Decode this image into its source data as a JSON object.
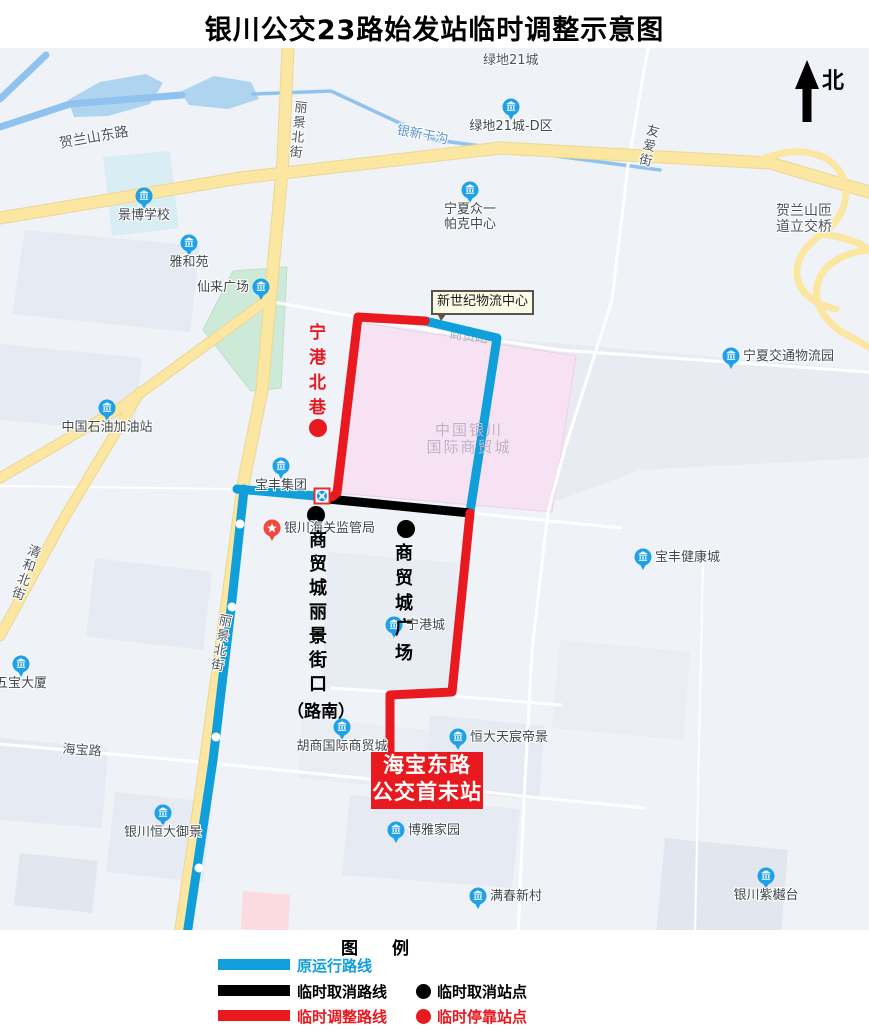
{
  "title": "银川公交23路始发站临时调整示意图",
  "north": {
    "label": "北"
  },
  "callout": {
    "text": "新世纪物流中心"
  },
  "terminus": {
    "line1": "海宝东路",
    "line2": "公交首末站"
  },
  "legend": {
    "title": "图　　例",
    "rows": [
      {
        "color": "#119fdc",
        "label": "原运行路线"
      },
      {
        "color": "#000000",
        "label": "临时取消路线",
        "dot_color": "#000000",
        "dot_label": "临时取消站点"
      },
      {
        "color": "#e8191f",
        "label": "临时调整路线",
        "dot_color": "#e8191f",
        "dot_label": "临时停靠站点"
      }
    ]
  },
  "colors": {
    "route_original": "#119fdc",
    "route_cancelled": "#000000",
    "route_adjusted": "#e8191f",
    "map_bg": "#eff2f7",
    "parcel": "#e6eaf2",
    "water": "#aed4f0",
    "water_line": "#8fc3ee",
    "road_yellow": "#fbe7a1",
    "road_yellow_edge": "#ecd793",
    "road_white": "#ffffff",
    "poi_blue": "#1ea1e6",
    "poi_red": "#f0483f",
    "area_label": "#c2b2c8"
  },
  "map": {
    "parcels": [
      {
        "p": [
          [
            25,
            230
          ],
          [
            200,
            246
          ],
          [
            190,
            332
          ],
          [
            12,
            314
          ]
        ]
      },
      {
        "p": [
          [
            0,
            344
          ],
          [
            142,
            358
          ],
          [
            134,
            432
          ],
          [
            0,
            420
          ]
        ]
      },
      {
        "p": [
          [
            95,
            558
          ],
          [
            212,
            572
          ],
          [
            203,
            650
          ],
          [
            86,
            637
          ]
        ]
      },
      {
        "p": [
          [
            0,
            738
          ],
          [
            108,
            748
          ],
          [
            102,
            828
          ],
          [
            0,
            820
          ]
        ]
      },
      {
        "p": [
          [
            328,
            552
          ],
          [
            458,
            563
          ],
          [
            450,
            700
          ],
          [
            322,
            688
          ]
        ],
        "f": "#e8ecf3"
      },
      {
        "p": [
          [
            438,
            333
          ],
          [
            869,
            370
          ],
          [
            869,
            458
          ],
          [
            640,
            470
          ],
          [
            560,
            500
          ],
          [
            445,
            505
          ]
        ],
        "f": "#e8ecf2"
      },
      {
        "p": [
          [
            560,
            640
          ],
          [
            690,
            652
          ],
          [
            683,
            740
          ],
          [
            552,
            728
          ]
        ],
        "f": "#eaeef4"
      },
      {
        "p": [
          [
            302,
            718
          ],
          [
            430,
            730
          ],
          [
            426,
            790
          ],
          [
            298,
            778
          ]
        ],
        "f": "#eaeef4"
      },
      {
        "p": [
          [
            430,
            715
          ],
          [
            545,
            726
          ],
          [
            539,
            800
          ],
          [
            424,
            789
          ]
        ]
      },
      {
        "p": [
          [
            350,
            795
          ],
          [
            520,
            809
          ],
          [
            512,
            888
          ],
          [
            342,
            875
          ]
        ]
      },
      {
        "p": [
          [
            665,
            838
          ],
          [
            788,
            850
          ],
          [
            781,
            935
          ],
          [
            656,
            935
          ]
        ],
        "f": "#e2e7ef"
      },
      {
        "p": [
          [
            115,
            792
          ],
          [
            212,
            802
          ],
          [
            203,
            882
          ],
          [
            106,
            872
          ]
        ]
      },
      {
        "p": [
          [
            20,
            853
          ],
          [
            98,
            861
          ],
          [
            92,
            913
          ],
          [
            14,
            905
          ]
        ],
        "f": "#e2e7ef"
      },
      {
        "p": [
          [
            103,
            157
          ],
          [
            170,
            151
          ],
          [
            179,
            228
          ],
          [
            112,
            236
          ]
        ],
        "f": "#d9edf4"
      },
      {
        "p": [
          [
            233,
            271
          ],
          [
            287,
            267
          ],
          [
            281,
            388
          ],
          [
            251,
            391
          ],
          [
            203,
            330
          ]
        ],
        "f": "#cdead8",
        "s": "#bfdfca"
      },
      {
        "p": [
          [
            357,
            322
          ],
          [
            576,
            356
          ],
          [
            552,
            512
          ],
          [
            337,
            493
          ]
        ],
        "f": "#f6e2f3",
        "s": "#ecd0e6",
        "name": "area-shangmaocheng"
      },
      {
        "p": [
          [
            243,
            891
          ],
          [
            290,
            895
          ],
          [
            288,
            932
          ],
          [
            241,
            929
          ]
        ],
        "f": "#fbdae0"
      }
    ],
    "water_polys": [
      [
        [
          68,
          100
        ],
        [
          100,
          82
        ],
        [
          146,
          74
        ],
        [
          163,
          83
        ],
        [
          150,
          104
        ],
        [
          108,
          116
        ],
        [
          74,
          117
        ]
      ],
      [
        [
          180,
          92
        ],
        [
          214,
          76
        ],
        [
          251,
          82
        ],
        [
          259,
          99
        ],
        [
          228,
          109
        ],
        [
          189,
          105
        ]
      ]
    ],
    "water_lines": [
      {
        "p": [
          [
            0,
            127
          ],
          [
            70,
            104
          ],
          [
            182,
            95
          ]
        ],
        "w": 7
      },
      {
        "p": [
          [
            0,
            99
          ],
          [
            46,
            55
          ]
        ],
        "w": 7
      },
      {
        "p": [
          [
            253,
            94
          ],
          [
            331,
            91
          ],
          [
            436,
            140
          ],
          [
            660,
            170
          ]
        ],
        "w": 3.5
      }
    ],
    "roads_white": [
      {
        "p": [
          [
            262,
            300
          ],
          [
            430,
            330
          ],
          [
            560,
            350
          ],
          [
            869,
            372
          ]
        ],
        "w": 3
      },
      {
        "p": [
          [
            648,
            48
          ],
          [
            628,
            165
          ],
          [
            612,
            300
          ],
          [
            565,
            448
          ],
          [
            548,
            512
          ],
          [
            532,
            650
          ],
          [
            524,
            800
          ],
          [
            518,
            935
          ]
        ],
        "w": 3
      },
      {
        "p": [
          [
            0,
            744
          ],
          [
            200,
            762
          ],
          [
            360,
            778
          ],
          [
            530,
            797
          ],
          [
            645,
            808
          ]
        ],
        "w": 3
      },
      {
        "p": [
          [
            0,
            486
          ],
          [
            237,
            489
          ]
        ],
        "w": 2
      },
      {
        "p": [
          [
            237,
            489
          ],
          [
            322,
            497
          ],
          [
            470,
            513
          ],
          [
            622,
            528
          ]
        ],
        "w": 3
      },
      {
        "p": [
          [
            330,
            688
          ],
          [
            452,
            696
          ],
          [
            562,
            705
          ]
        ],
        "w": 3
      },
      {
        "p": [
          [
            703,
            560
          ],
          [
            695,
            935
          ]
        ],
        "w": 2
      }
    ],
    "roads_yellow": [
      {
        "p": [
          [
            0,
            218
          ],
          [
            240,
            178
          ],
          [
            500,
            148
          ],
          [
            770,
            163
          ],
          [
            869,
            192
          ]
        ],
        "w": 11
      },
      {
        "p": [
          [
            288,
            48
          ],
          [
            283,
            160
          ],
          [
            262,
            390
          ],
          [
            244,
            480
          ],
          [
            222,
            640
          ],
          [
            200,
            800
          ],
          [
            180,
            935
          ]
        ],
        "w": 11
      },
      {
        "p": [
          [
            270,
            298
          ],
          [
            120,
            408
          ],
          [
            0,
            478
          ]
        ],
        "w": 9
      },
      {
        "p": [
          [
            140,
            392
          ],
          [
            63,
            520
          ],
          [
            0,
            636
          ]
        ],
        "w": 9
      }
    ],
    "ramps": [
      "M760,160 C840,128 872,198 822,234 C782,261 792,300 836,309",
      "M869,250 C812,256 800,302 840,331 L869,347",
      "M822,234 C850,238 862,244 869,250"
    ],
    "under_label": {
      "text": "商贸路",
      "x": 449,
      "y": 338,
      "rot": 7,
      "size": 13,
      "color": "#a8b1bd"
    },
    "routes": [
      {
        "name": "route-original",
        "color_key": "route_original",
        "polylines": [
          [
            [
              425,
              321
            ],
            [
              497,
              338
            ],
            [
              470,
              512
            ]
          ],
          [
            [
              237,
              489
            ],
            [
              316,
              496
            ]
          ],
          [
            [
              244,
              489
            ],
            [
              232,
              600
            ],
            [
              213,
              760
            ],
            [
              187,
              935
            ]
          ]
        ]
      },
      {
        "name": "route-cancelled",
        "color_key": "route_cancelled",
        "polylines": [
          [
            [
              318,
              498
            ],
            [
              470,
              513
            ]
          ]
        ]
      },
      {
        "name": "route-adjusted",
        "color_key": "route_adjusted",
        "polylines": [
          [
            [
              425,
              321
            ],
            [
              358,
              317
            ],
            [
              337,
              493
            ],
            [
              332,
              497
            ]
          ],
          [
            [
              470,
              513
            ],
            [
              452,
              692
            ],
            [
              390,
              695
            ],
            [
              390,
              756
            ]
          ]
        ]
      }
    ],
    "blue_line_stations": [
      [
        240,
        524
      ],
      [
        232,
        607
      ],
      [
        216,
        737
      ],
      [
        199,
        868
      ]
    ],
    "stops_cancelled": [
      [
        316,
        515
      ],
      [
        406,
        529
      ]
    ],
    "stops_temporary": [
      [
        318,
        428
      ]
    ],
    "crossing": {
      "x": 322,
      "y": 496
    },
    "pois": [
      {
        "x": 144,
        "y": 196,
        "label": "景博学校",
        "pos": "below"
      },
      {
        "x": 189,
        "y": 243,
        "label": "雅和苑",
        "pos": "below"
      },
      {
        "x": 261,
        "y": 287,
        "label": "仙来广场",
        "pos": "left"
      },
      {
        "x": 511,
        "y": 107,
        "label": "绿地21城-D区",
        "pos": "below"
      },
      {
        "x": 470,
        "y": 190,
        "lines": [
          "宁夏众一",
          "帕克中心"
        ],
        "label": "宁夏众一帕克中心",
        "pos": "below"
      },
      {
        "x": 731,
        "y": 356,
        "label": "宁夏交通物流园",
        "pos": "right"
      },
      {
        "x": 107,
        "y": 408,
        "label": "中国石油加油站",
        "pos": "below"
      },
      {
        "x": 281,
        "y": 466,
        "label": "宝丰集团",
        "pos": "below"
      },
      {
        "x": 272,
        "y": 528,
        "label": "银川海关监管局",
        "pos": "right",
        "type": "red"
      },
      {
        "x": 394,
        "y": 625,
        "label": "宁港城",
        "pos": "right"
      },
      {
        "x": 643,
        "y": 557,
        "label": "宝丰健康城",
        "pos": "right"
      },
      {
        "x": 21,
        "y": 664,
        "label": "五宝大厦",
        "pos": "below"
      },
      {
        "x": 342,
        "y": 727,
        "label": "胡商国际商贸城",
        "pos": "below"
      },
      {
        "x": 458,
        "y": 737,
        "label": "恒大天宸帝景",
        "pos": "right"
      },
      {
        "x": 396,
        "y": 830,
        "label": "博雅家园",
        "pos": "right"
      },
      {
        "x": 478,
        "y": 896,
        "label": "满春新村",
        "pos": "right"
      },
      {
        "x": 766,
        "y": 876,
        "label": "银川紫樾台",
        "pos": "below"
      },
      {
        "x": 163,
        "y": 813,
        "label": "银川恒大御景",
        "pos": "below"
      }
    ],
    "text_labels": [
      {
        "text": "贺兰山东路",
        "x": 58,
        "y": 136,
        "rot": -10,
        "size": 14
      },
      {
        "text": "丽景北街",
        "x": 295,
        "y": 101,
        "vertical": true,
        "rot": 6,
        "size": 13
      },
      {
        "text": "银新干沟",
        "x": 398,
        "y": 124,
        "rot": 11,
        "size": 13,
        "color": "#5a93cc"
      },
      {
        "text": "友爱街",
        "x": 648,
        "y": 124,
        "vertical": true,
        "rot": 14,
        "size": 13
      },
      {
        "text": "清和北街",
        "x": 30,
        "y": 544,
        "vertical": true,
        "rot": 20,
        "size": 13
      },
      {
        "text": "丽景北街",
        "x": 220,
        "y": 614,
        "vertical": true,
        "rot": 10,
        "size": 13
      },
      {
        "text": "海宝路",
        "x": 63,
        "y": 743,
        "rot": 4,
        "size": 13
      },
      {
        "text": "绿地21城",
        "x": 483,
        "y": 54,
        "size": 13
      },
      {
        "lines": [
          "贺兰山匝",
          "道立交桥"
        ],
        "text": "贺兰山匝道立交桥",
        "x": 776,
        "y": 203,
        "size": 14
      }
    ],
    "area_label": {
      "lines": [
        "中国银川",
        "国际商贸城"
      ],
      "x": 389,
      "y": 422,
      "w": 160,
      "size": 15
    },
    "station_labels": [
      {
        "chars": "商贸城丽景街口",
        "x": 309,
        "y": 526,
        "size": 18,
        "gap": 6,
        "color": "#000",
        "suffix": {
          "text": "（路南）",
          "x": 287,
          "y": 697,
          "size": 17
        }
      },
      {
        "chars": "商贸城广场",
        "x": 395,
        "y": 539,
        "size": 18,
        "gap": 7,
        "color": "#000"
      }
    ],
    "lane_label": {
      "chars": "宁港北巷",
      "x": 309,
      "y": 318,
      "size": 17,
      "gap": 8,
      "color": "#e8191f"
    }
  }
}
